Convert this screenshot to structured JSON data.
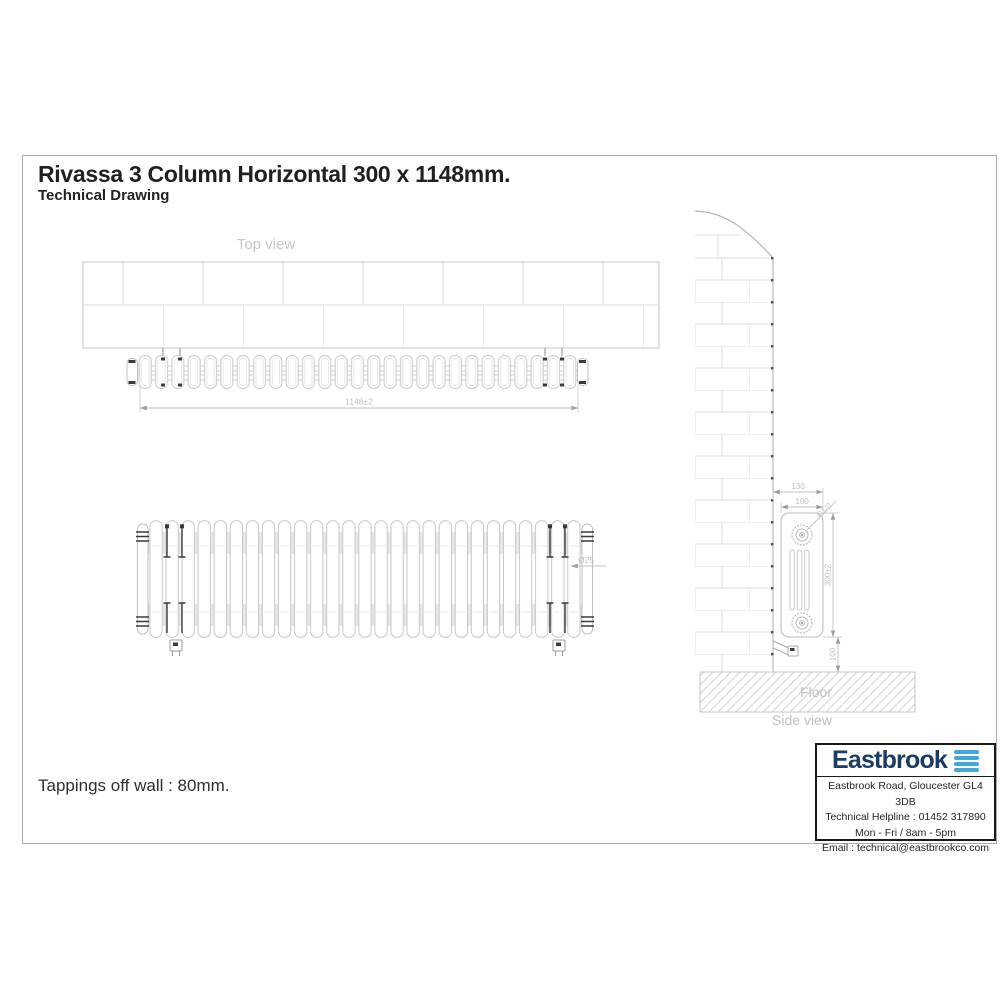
{
  "page": {
    "title": "Rivassa 3 Column Horizontal 300 x 1148mm.",
    "subtitle": "Technical Drawing",
    "note": "Tappings off wall : 80mm."
  },
  "drawing": {
    "top_view": {
      "label": "Top view",
      "width_dim": "1148±2",
      "sections": 27
    },
    "front_view": {
      "column_diameter_dim": "Ø25",
      "columns": 27
    },
    "side_view": {
      "label": "Side view",
      "floor_label": "Floor",
      "wall_to_front_dim": "130",
      "depth_dim": "100",
      "tapping_dim": "G1/2",
      "height_dim": "300±2",
      "floor_clearance_dim": "100"
    }
  },
  "info_box": {
    "brand": "Eastbrook",
    "address": "Eastbrook Road, Gloucester GL4 3DB",
    "helpline": "Technical Helpline : 01452 317890",
    "hours": "Mon - Fri / 8am - 5pm",
    "email": "Email : technical@eastbrookco.com"
  },
  "colors": {
    "line_light": "#c6c6c6",
    "brick_line": "#dadada",
    "dim_text": "#bfbfbf",
    "dark_mark": "#3a3a3a",
    "text_dark": "#231f20",
    "brand_navy": "#1d3c61",
    "brand_blue": "#42a7d8",
    "page_border": "#ababab"
  }
}
